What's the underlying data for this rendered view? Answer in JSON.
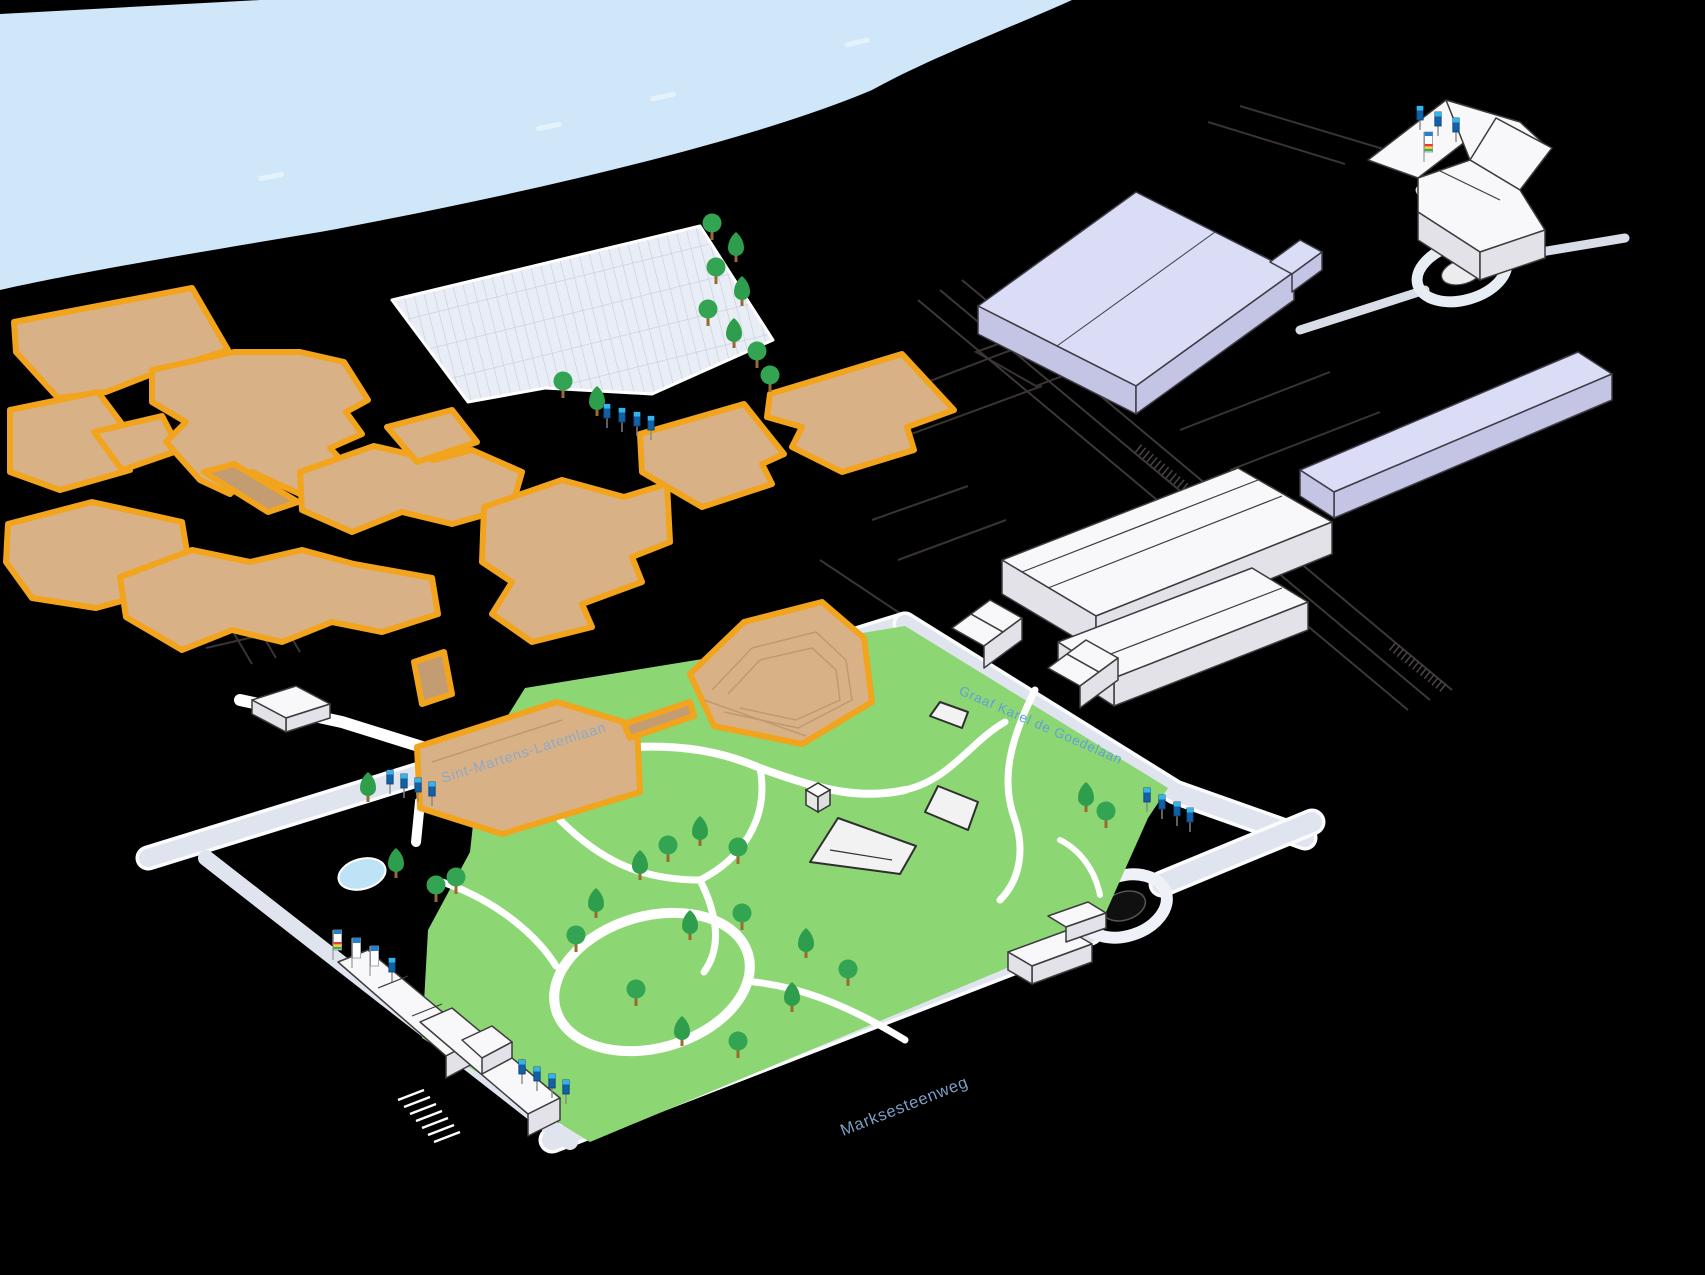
{
  "map_name": "Isometric campus map",
  "streets": {
    "sint_martens_latemlaan": "Sint-Martens-Latemlaan",
    "graaf_karel_de_goedelaan": "Graaf Karel de Goedelaan",
    "marksesteenweg": "Marksesteenweg"
  },
  "icons": {
    "wayfinding_totem": "blue-totem-sign",
    "banner_flag": "white-banner-flag",
    "rainbow_banner_flag": "rainbow-banner-flag",
    "tree_round": "round-tree",
    "tree_cone": "conical-tree"
  },
  "colors": {
    "background": "#000000",
    "river": "#CFE7F8",
    "park": "#8CD673",
    "road": "#DFE4EE",
    "highlight_outline": "#F2A41D",
    "highlight_building": "#D9B187",
    "building_white": "#F8F8FA",
    "building_lavender": "#DBDCF5",
    "tree": "#2F9E4C",
    "totem_blue": "#1161A8",
    "street_label": "#8FA9C4"
  }
}
